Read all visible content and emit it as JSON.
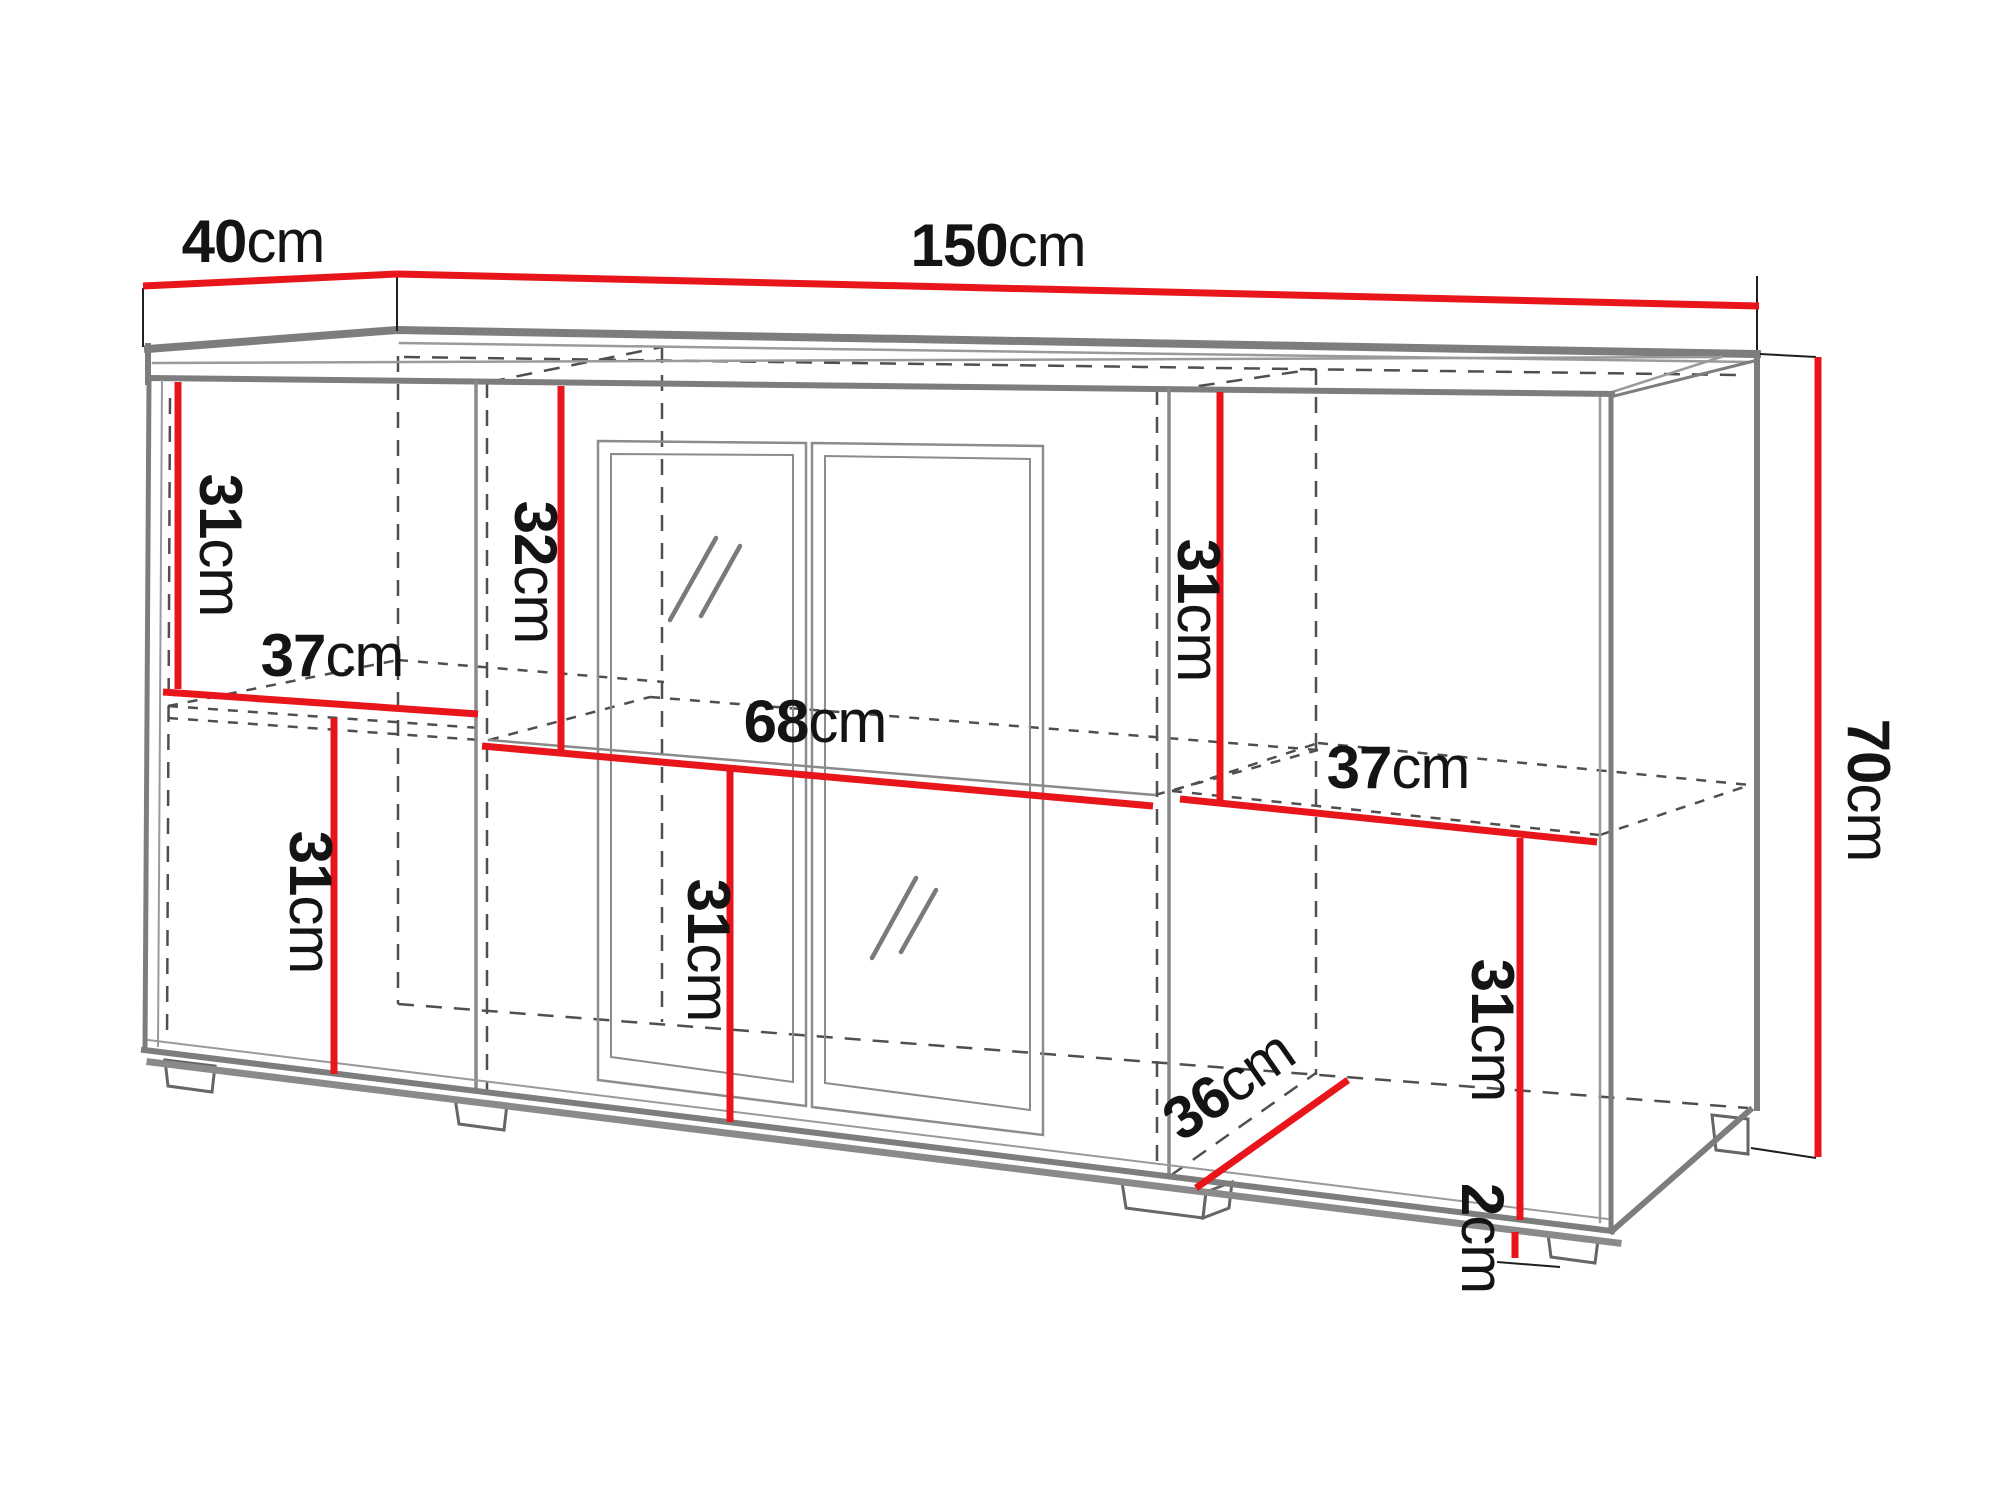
{
  "diagram": {
    "type": "furniture-dimension-drawing",
    "subject": "sideboard-wireframe",
    "unit": "cm",
    "colors": {
      "dimension_accent": "#e8151b",
      "wireframe_gray": "#7d7d7d",
      "hidden_line": "#4f4f4f",
      "label_text": "#141414",
      "background": "#ffffff"
    }
  },
  "dims": {
    "d40": {
      "value": "40",
      "unit": "cm"
    },
    "d150": {
      "value": "150",
      "unit": "cm"
    },
    "d70": {
      "value": "70",
      "unit": "cm"
    },
    "l31top": {
      "value": "31",
      "unit": "cm"
    },
    "c32": {
      "value": "32",
      "unit": "cm"
    },
    "r31top": {
      "value": "31",
      "unit": "cm"
    },
    "l37": {
      "value": "37",
      "unit": "cm"
    },
    "c68": {
      "value": "68",
      "unit": "cm"
    },
    "r37": {
      "value": "37",
      "unit": "cm"
    },
    "l31bot": {
      "value": "31",
      "unit": "cm"
    },
    "c31bot": {
      "value": "31",
      "unit": "cm"
    },
    "r31bot": {
      "value": "31",
      "unit": "cm"
    },
    "d36": {
      "value": "36",
      "unit": "cm"
    },
    "d2": {
      "value": "2",
      "unit": "cm"
    }
  }
}
